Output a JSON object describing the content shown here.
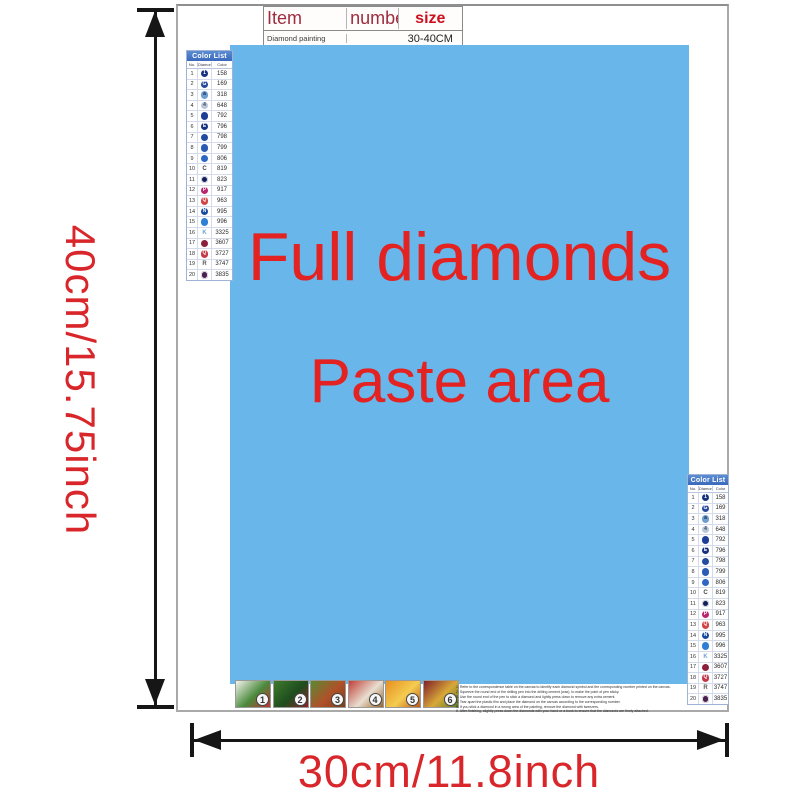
{
  "dimensions": {
    "height_label": "40cm/15.75inch",
    "width_label": "30cm/11.8inch",
    "accent_color": "#d8262a"
  },
  "spec_table": {
    "header": {
      "item": "Item",
      "number": "number",
      "size": "size"
    },
    "row": {
      "item": "Diamond painting",
      "number": "",
      "size": "30-40CM"
    }
  },
  "paste_area": {
    "line1": "Full diamonds",
    "line2": "Paste area",
    "bg_color": "#69b6ea",
    "text_color": "#e32222"
  },
  "color_list": {
    "title": "Color List",
    "columns": {
      "no": "No.",
      "symbol": "Diamond",
      "code": "Color"
    },
    "rows": [
      {
        "no": "1",
        "code": "158",
        "type": "circle",
        "symbol": "1",
        "bg": "#16337f",
        "fg": "#ffffff"
      },
      {
        "no": "2",
        "code": "169",
        "type": "circle",
        "symbol": "G",
        "bg": "#27489b",
        "fg": "#ffffff"
      },
      {
        "no": "3",
        "code": "318",
        "type": "circle",
        "symbol": "a",
        "bg": "#6f9ed0",
        "fg": "#1c2c50"
      },
      {
        "no": "4",
        "code": "648",
        "type": "circle",
        "symbol": "4",
        "bg": "#b9c6d8",
        "fg": "#3a4a60"
      },
      {
        "no": "5",
        "code": "792",
        "type": "circle",
        "symbol": "",
        "bg": "#1d3f96",
        "fg": "#ffffff"
      },
      {
        "no": "6",
        "code": "796",
        "type": "circle",
        "symbol": "E",
        "bg": "#16337f",
        "fg": "#ffffff"
      },
      {
        "no": "7",
        "code": "798",
        "type": "circle",
        "symbol": "",
        "bg": "#234c9f",
        "fg": "#ffffff"
      },
      {
        "no": "8",
        "code": "799",
        "type": "circle",
        "symbol": "",
        "bg": "#2c5bb4",
        "fg": "#ffffff"
      },
      {
        "no": "9",
        "code": "806",
        "type": "circle",
        "symbol": "",
        "bg": "#2e66c4",
        "fg": "#ffffff"
      },
      {
        "no": "10",
        "code": "819",
        "type": "text",
        "symbol": "C",
        "bg": "",
        "fg": "#444444"
      },
      {
        "no": "11",
        "code": "823",
        "type": "ring",
        "symbol": "",
        "bg": "#101f5c",
        "fg": "#ffffff"
      },
      {
        "no": "12",
        "code": "917",
        "type": "circle",
        "symbol": "P",
        "bg": "#b92470",
        "fg": "#ffffff"
      },
      {
        "no": "13",
        "code": "963",
        "type": "circle",
        "symbol": "Q",
        "bg": "#d04545",
        "fg": "#ffffff"
      },
      {
        "no": "14",
        "code": "995",
        "type": "circle",
        "symbol": "N",
        "bg": "#174a9e",
        "fg": "#ffffff"
      },
      {
        "no": "15",
        "code": "996",
        "type": "circle",
        "symbol": "",
        "bg": "#2f7fd4",
        "fg": "#ffffff"
      },
      {
        "no": "16",
        "code": "3325",
        "type": "text",
        "symbol": "K",
        "bg": "",
        "fg": "#6fa3d8"
      },
      {
        "no": "17",
        "code": "3607",
        "type": "circle",
        "symbol": "",
        "bg": "#8c1f3c",
        "fg": "#ffffff"
      },
      {
        "no": "18",
        "code": "3727",
        "type": "circle",
        "symbol": "Q",
        "bg": "#c23a4a",
        "fg": "#ffffff"
      },
      {
        "no": "19",
        "code": "3747",
        "type": "text",
        "symbol": "R",
        "bg": "",
        "fg": "#555555"
      },
      {
        "no": "20",
        "code": "3835",
        "type": "ring",
        "symbol": "",
        "bg": "#4a2050",
        "fg": "#ffffff"
      }
    ]
  },
  "steps": {
    "thumbnails": [
      {
        "number": "1",
        "colors": [
          "#f5f3ee",
          "#4a8a3c",
          "#c03030"
        ]
      },
      {
        "number": "2",
        "colors": [
          "#3f7a2e",
          "#1e4d1e",
          "#8a2424"
        ]
      },
      {
        "number": "3",
        "colors": [
          "#5a8a30",
          "#b0502a",
          "#7a4018"
        ]
      },
      {
        "number": "4",
        "colors": [
          "#c04038",
          "#e8ded0",
          "#9a6428"
        ]
      },
      {
        "number": "5",
        "colors": [
          "#e89020",
          "#f4cc50",
          "#c05a1a"
        ]
      },
      {
        "number": "6",
        "colors": [
          "#801f2a",
          "#d8a838",
          "#5a7a28"
        ]
      }
    ],
    "instructions": [
      "1. Refer to the correspondence table on the canvas to identify each diamond symbol and the corresponding number printed on the canvas.",
      "2. Squeeze the round end of the drilling pen into the drilling cement (wax), to make the point of pen sticky.",
      "3. Use the round end of the pen to stick a diamond and lightly press down to remove any extra cement.",
      "4. Tear apart the plastic film and place the diamond on the canvas according to the corresponding number.",
      "5. If you stick a diamond in a wrong area of the painting, remove the diamond with tweezers.",
      "6. After finishing, slightly press down the diamonds with your hand or a book to ensure that the diamonds are firmly attached."
    ]
  }
}
